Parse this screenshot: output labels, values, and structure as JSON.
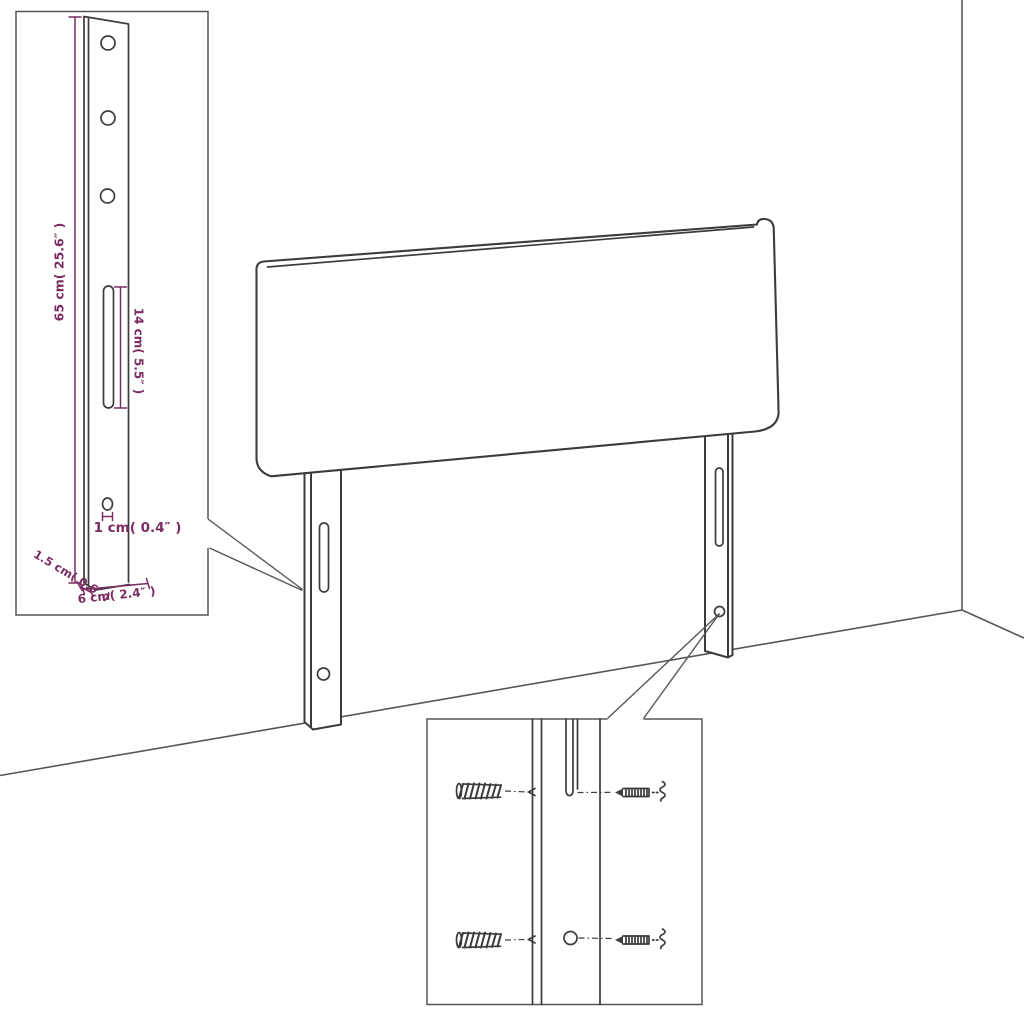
{
  "colors": {
    "accent": "#7b2d62",
    "line": "#3c3c3c",
    "wall": "#565656",
    "background": "#ffffff"
  },
  "inset_dimensions": {
    "height": "65 cm( 25.6″ )",
    "slot_length": "14 cm( 5.5″ )",
    "hole_diameter": "1 cm( 0.4″ )",
    "thickness": "1.5 cm( 0.6″ )",
    "width": "6 cm( 2.4″ )"
  }
}
